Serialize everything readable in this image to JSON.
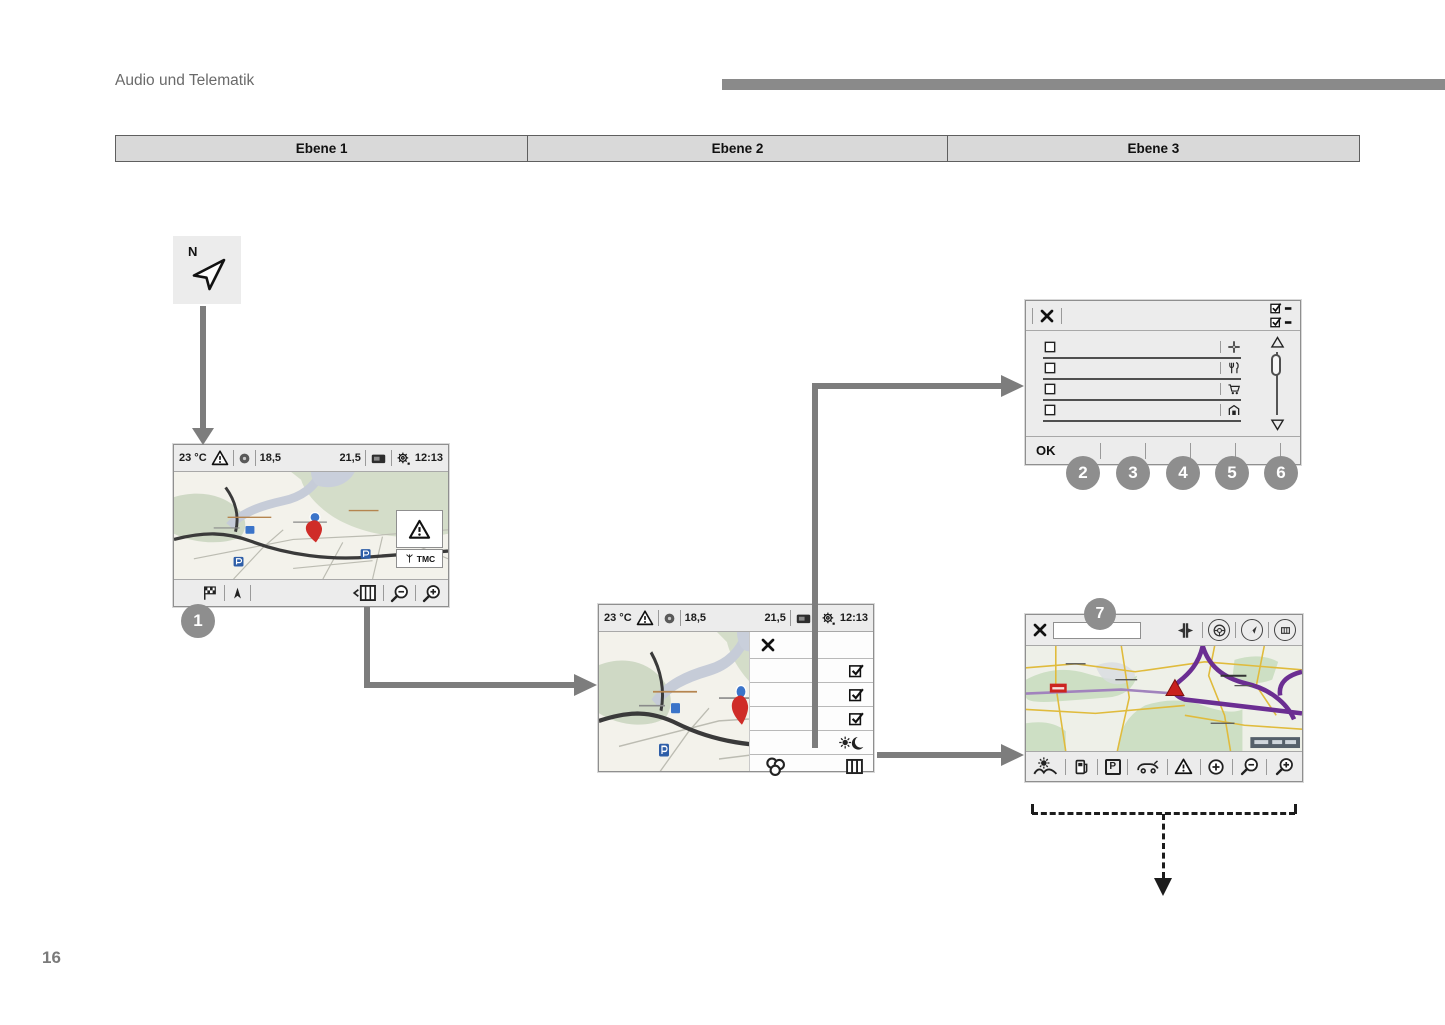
{
  "header": {
    "section_title": "Audio und Telematik"
  },
  "levels_table": {
    "columns": [
      "Ebene 1",
      "Ebene 2",
      "Ebene 3"
    ]
  },
  "compass_tile": {
    "north_label": "N"
  },
  "callout_numbers": {
    "n1": "1",
    "n2": "2",
    "n3": "3",
    "n4": "4",
    "n5": "5",
    "n6": "6",
    "n7": "7"
  },
  "nav_screen_1": {
    "status": {
      "temperature": "23 °C",
      "left_value": "18,5",
      "right_value": "21,5",
      "time": "12:13"
    },
    "traffic": {
      "tmc_label": "TMC"
    }
  },
  "nav_screen_2": {
    "status": {
      "temperature": "23 °C",
      "left_value": "18,5",
      "right_value": "21,5",
      "time": "12:13"
    }
  },
  "poi_panel": {
    "ok_label": "OK"
  },
  "nav_screen_3": {
    "toolbar": {
      "parking_label": "P"
    }
  },
  "footer": {
    "page_number": "16"
  },
  "colors": {
    "arrow_gray": "#7d7d7d",
    "callout_gray": "#8e8e8e",
    "table_header_bg": "#d9d9d9",
    "motorway_purple": "#6b2e92",
    "road_yellow": "#e0bb3c",
    "marker_red": "#c9201d"
  }
}
